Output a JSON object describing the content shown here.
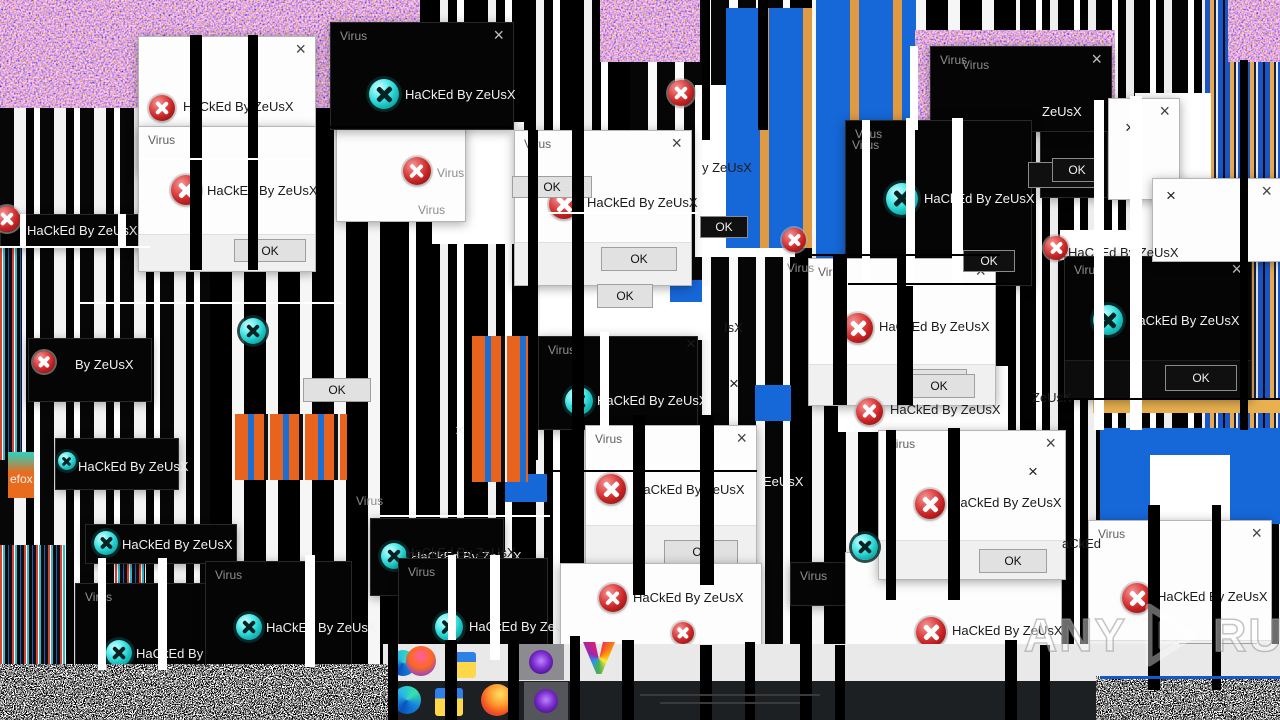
{
  "ui": {
    "virus_title": "Virus",
    "hacked_text": "HaCkEd By ZeUsX",
    "ok_label": "OK",
    "close_glyph": "×"
  },
  "watermark": {
    "left": "ANY",
    "right": "RUN"
  },
  "colors": {
    "dialog_light_bg": "#fdfdfd",
    "dialog_dark_bg": "#050505",
    "error_icon_red": "#c42222",
    "error_icon_cyan": "#1cc6c6",
    "glitch_blue": "#1667d8",
    "glitch_orange": "#e8641e",
    "taskbar_dark": "#1d2023"
  },
  "dialogs": [
    {
      "x": 0,
      "y": 214,
      "w": 148,
      "h": 32,
      "v": "dark",
      "bare": true,
      "close": false,
      "icon": "none",
      "msg": true,
      "mx": 26,
      "my": 8
    },
    {
      "x": 55,
      "y": 438,
      "w": 122,
      "h": 50,
      "v": "dark",
      "bare": true,
      "close": false,
      "icon": "none",
      "msg": true,
      "mx": 22,
      "my": 20
    },
    {
      "x": 28,
      "y": 338,
      "w": 122,
      "h": 62,
      "v": "dark",
      "bare": true,
      "close": false,
      "icon": "red",
      "ix": 4,
      "iy": 12,
      "is": 22,
      "msg": false
    },
    {
      "x": 790,
      "y": 562,
      "w": 70,
      "h": 42,
      "v": "dark",
      "title": "Virus",
      "close": false,
      "icon": "none",
      "msg": false
    },
    {
      "x": 1040,
      "y": 92,
      "w": 66,
      "h": 104,
      "v": "dark",
      "bare": true,
      "close": false,
      "icon": "none",
      "msg": false
    },
    {
      "x": 336,
      "y": 124,
      "w": 128,
      "h": 96,
      "v": "light",
      "bare": true,
      "close": false,
      "icon": "red",
      "ix": 66,
      "iy": 32,
      "is": 28,
      "msg": false
    },
    {
      "x": 138,
      "y": 36,
      "w": 176,
      "h": 136,
      "v": "light",
      "title": "",
      "close": true,
      "icon": "red",
      "ix": 10,
      "iy": 58,
      "is": 26,
      "msg": true,
      "mx": 44,
      "my": 62
    },
    {
      "x": 138,
      "y": 126,
      "w": 176,
      "h": 144,
      "v": "light",
      "title": "Virus",
      "close": false,
      "icon": "red",
      "ix": 32,
      "iy": 48,
      "is": 30,
      "msg": true,
      "mx": 68,
      "my": 56,
      "fh": 36,
      "ok": {
        "x": 95,
        "y": 112,
        "w": 72,
        "h": 23
      }
    },
    {
      "x": 330,
      "y": 22,
      "w": 182,
      "h": 106,
      "v": "dark",
      "title": "Virus",
      "close": true,
      "icon": "cyan",
      "ix": 38,
      "iy": 56,
      "is": 30,
      "msg": true,
      "mx": 74,
      "my": 64
    },
    {
      "x": 930,
      "y": 46,
      "w": 180,
      "h": 84,
      "v": "dark",
      "title": "Virus",
      "close": true,
      "icon": "none",
      "msg": false
    },
    {
      "x": 845,
      "y": 120,
      "w": 185,
      "h": 164,
      "v": "dark",
      "title": "Virus",
      "close": false,
      "icon": "cyan",
      "ix": 40,
      "iy": 62,
      "is": 32,
      "msg": true,
      "mx": 78,
      "my": 70
    },
    {
      "x": 514,
      "y": 130,
      "w": 176,
      "h": 154,
      "v": "light",
      "title": "Virus",
      "close": true,
      "icon": "red",
      "ix": 34,
      "iy": 58,
      "is": 30,
      "msg": true,
      "mx": 72,
      "my": 64,
      "fh": 42,
      "ok": {
        "x": 86,
        "y": 116,
        "w": 76,
        "h": 24
      }
    },
    {
      "x": 808,
      "y": 258,
      "w": 186,
      "h": 146,
      "v": "light",
      "title": "Virus",
      "close": true,
      "icon": "red",
      "ix": 34,
      "iy": 54,
      "is": 30,
      "msg": true,
      "mx": 70,
      "my": 60,
      "fh": 40,
      "ok": {
        "x": 90,
        "y": 110,
        "w": 68,
        "h": 24
      }
    },
    {
      "x": 1064,
      "y": 256,
      "w": 186,
      "h": 142,
      "v": "dark",
      "title": "Virus",
      "close": true,
      "icon": "cyan",
      "ix": 28,
      "iy": 48,
      "is": 30,
      "msg": true,
      "mx": 64,
      "my": 56,
      "fh": 38,
      "ok": {
        "x": 100,
        "y": 108,
        "w": 72,
        "h": 26
      }
    },
    {
      "x": 538,
      "y": 336,
      "w": 158,
      "h": 92,
      "v": "dark",
      "title": "Virus",
      "close": false,
      "icon": "cyan",
      "ix": 26,
      "iy": 50,
      "is": 28,
      "msg": true,
      "mx": 58,
      "my": 56
    },
    {
      "x": 1108,
      "y": 98,
      "w": 70,
      "h": 100,
      "v": "light",
      "title": "",
      "close": true,
      "icon": "none",
      "msg": false
    },
    {
      "x": 1152,
      "y": 178,
      "w": 128,
      "h": 82,
      "v": "light",
      "title": "",
      "close": true,
      "icon": "none",
      "msg": false
    },
    {
      "x": 585,
      "y": 425,
      "w": 170,
      "h": 144,
      "v": "light",
      "title": "Virus",
      "close": true,
      "icon": "red",
      "ix": 10,
      "iy": 48,
      "is": 30,
      "msg": true,
      "mx": 48,
      "my": 56,
      "fh": 44,
      "ok": {
        "x": 78,
        "y": 114,
        "w": 74,
        "h": 24
      }
    },
    {
      "x": 370,
      "y": 518,
      "w": 132,
      "h": 76,
      "v": "dark",
      "bare": true,
      "close": false,
      "icon": "cyan",
      "ix": 10,
      "iy": 24,
      "is": 26,
      "msg": true,
      "mx": 40,
      "my": 30
    },
    {
      "x": 398,
      "y": 558,
      "w": 148,
      "h": 102,
      "v": "dark",
      "title": "Virus",
      "close": false,
      "icon": "cyan",
      "ix": 36,
      "iy": 54,
      "is": 28,
      "msg": true,
      "mx": 70,
      "my": 60
    },
    {
      "x": 85,
      "y": 524,
      "w": 150,
      "h": 38,
      "v": "dark",
      "bare": true,
      "close": false,
      "icon": "cyan",
      "ix": 8,
      "iy": 6,
      "is": 24,
      "msg": true,
      "mx": 36,
      "my": 12
    },
    {
      "x": 75,
      "y": 583,
      "w": 132,
      "h": 84,
      "v": "dark",
      "title": "Virus",
      "close": false,
      "icon": "cyan",
      "ix": 30,
      "iy": 56,
      "is": 26,
      "msg": true,
      "mx": 60,
      "my": 62
    },
    {
      "x": 205,
      "y": 561,
      "w": 145,
      "h": 106,
      "v": "dark",
      "title": "Virus",
      "close": false,
      "icon": "cyan",
      "ix": 30,
      "iy": 52,
      "is": 26,
      "msg": true,
      "mx": 60,
      "my": 58
    },
    {
      "x": 560,
      "y": 563,
      "w": 200,
      "h": 98,
      "v": "light",
      "bare": true,
      "close": false,
      "icon": "red",
      "ix": 38,
      "iy": 20,
      "is": 28,
      "msg": true,
      "mx": 72,
      "my": 26
    },
    {
      "x": 845,
      "y": 552,
      "w": 215,
      "h": 128,
      "v": "light",
      "bare": true,
      "close": false,
      "icon": "red",
      "ix": 70,
      "iy": 64,
      "is": 30,
      "msg": true,
      "mx": 106,
      "my": 70
    },
    {
      "x": 878,
      "y": 430,
      "w": 186,
      "h": 148,
      "v": "light",
      "title": "Virus",
      "close": true,
      "icon": "red",
      "ix": 36,
      "iy": 58,
      "is": 30,
      "msg": true,
      "mx": 72,
      "my": 64,
      "fh": 38,
      "ok": {
        "x": 100,
        "y": 118,
        "w": 68,
        "h": 24
      }
    },
    {
      "x": 1088,
      "y": 520,
      "w": 182,
      "h": 160,
      "v": "light",
      "title": "Virus",
      "close": true,
      "icon": "red",
      "ix": 33,
      "iy": 62,
      "is": 30,
      "msg": true,
      "mx": 68,
      "my": 68,
      "fh": 40,
      "ok": {
        "x": 90,
        "y": 122,
        "w": 78,
        "h": 26
      }
    }
  ],
  "buttons": [
    {
      "x": 512,
      "y": 176,
      "w": 80,
      "h": 22,
      "v": "light"
    },
    {
      "x": 597,
      "y": 284,
      "w": 56,
      "h": 24,
      "v": "light"
    },
    {
      "x": 303,
      "y": 378,
      "w": 68,
      "h": 24,
      "v": "light"
    },
    {
      "x": 903,
      "y": 374,
      "w": 72,
      "h": 24,
      "v": "light"
    },
    {
      "x": 700,
      "y": 216,
      "w": 48,
      "h": 22,
      "v": "dark"
    },
    {
      "x": 963,
      "y": 250,
      "w": 52,
      "h": 22,
      "v": "dark"
    },
    {
      "x": 1028,
      "y": 162,
      "w": 74,
      "h": 26,
      "v": "dark"
    },
    {
      "x": 1052,
      "y": 158,
      "w": 50,
      "h": 24,
      "v": "dark"
    },
    {
      "x": 1188,
      "y": 684,
      "w": 60,
      "h": 24,
      "v": "dark"
    },
    {
      "x": 988,
      "y": 685,
      "w": 46,
      "h": 22,
      "v": "dark"
    }
  ],
  "icons": [
    {
      "x": 668,
      "y": 80,
      "s": 26,
      "variant": "red"
    },
    {
      "x": 856,
      "y": 398,
      "s": 27,
      "variant": "red"
    },
    {
      "x": 852,
      "y": 534,
      "s": 26,
      "variant": "cyan"
    },
    {
      "x": 240,
      "y": 318,
      "s": 26,
      "variant": "cyan"
    },
    {
      "x": -6,
      "y": 206,
      "s": 26,
      "variant": "red"
    },
    {
      "x": 58,
      "y": 452,
      "s": 18,
      "variant": "cyan"
    },
    {
      "x": 672,
      "y": 622,
      "s": 22,
      "variant": "red"
    },
    {
      "x": 1044,
      "y": 236,
      "s": 24,
      "variant": "red"
    },
    {
      "x": 782,
      "y": 228,
      "s": 24,
      "variant": "red"
    }
  ],
  "fragments": [
    {
      "x": 75,
      "y": 357,
      "text": "By ZeUsX",
      "tone": "light"
    },
    {
      "x": 1042,
      "y": 104,
      "text": "ZeUsX",
      "tone": "light"
    },
    {
      "x": 1032,
      "y": 390,
      "text": "ZeUsX",
      "tone": "dark"
    },
    {
      "x": 1068,
      "y": 245,
      "text": "HaCkEd By ZeUsX",
      "tone": "dark"
    },
    {
      "x": 890,
      "y": 402,
      "text": "HaCkEd By ZeUsX",
      "tone": "dark"
    },
    {
      "x": 405,
      "y": 545,
      "text": "HaCkEd By ZeUsX",
      "tone": "dark"
    },
    {
      "x": 1062,
      "y": 536,
      "text": "aCkEd",
      "tone": "dark"
    },
    {
      "x": 763,
      "y": 474,
      "text": "EeUsX",
      "tone": "light"
    },
    {
      "x": 724,
      "y": 320,
      "text": "IsX",
      "tone": "dark"
    },
    {
      "x": 702,
      "y": 160,
      "text": "y ZeUsX",
      "tone": "dark"
    },
    {
      "x": 746,
      "y": 643,
      "text": "HaCkEd By",
      "tone": "faint",
      "s": 12
    },
    {
      "x": 437,
      "y": 166,
      "text": "Virus",
      "tone": "gray",
      "s": 12
    },
    {
      "x": 418,
      "y": 203,
      "text": "Virus",
      "tone": "gray",
      "s": 12
    },
    {
      "x": 962,
      "y": 58,
      "text": "Virus",
      "tone": "gray",
      "s": 12
    },
    {
      "x": 787,
      "y": 261,
      "text": "Virus",
      "tone": "gray",
      "s": 12
    },
    {
      "x": 852,
      "y": 138,
      "text": "Virus",
      "tone": "gray",
      "s": 12
    },
    {
      "x": 356,
      "y": 494,
      "text": "Virus",
      "tone": "gray",
      "s": 12
    },
    {
      "x": 10,
      "y": 472,
      "text": "efox",
      "tone": "light",
      "s": 12
    },
    {
      "x": 1125,
      "y": 118,
      "text": "×",
      "tone": "dark",
      "s": 17
    },
    {
      "x": 1166,
      "y": 186,
      "text": "×",
      "tone": "dark",
      "s": 17
    },
    {
      "x": 686,
      "y": 334,
      "text": "×",
      "tone": "dark",
      "s": 17
    },
    {
      "x": 729,
      "y": 374,
      "text": "×",
      "tone": "dark",
      "s": 17
    },
    {
      "x": 1028,
      "y": 462,
      "text": "×",
      "tone": "dark",
      "s": 17
    },
    {
      "x": 455,
      "y": 421,
      "text": "×",
      "tone": "light",
      "s": 17
    }
  ],
  "taskbar": {
    "items": [
      {
        "type": "edge",
        "x": 390,
        "y": 650,
        "s": 26,
        "row": 1
      },
      {
        "type": "firefox-glitch",
        "x": 406,
        "y": 646,
        "s": 30,
        "row": 1
      },
      {
        "type": "folder",
        "x": 450,
        "y": 652,
        "s": 26,
        "row": 1
      },
      {
        "type": "purple-tile",
        "x": 518,
        "y": 644,
        "w": 46,
        "h": 36,
        "row": 1
      },
      {
        "type": "glitch-v",
        "x": 583,
        "y": 642,
        "s": 32,
        "row": 1
      },
      {
        "type": "edge",
        "x": 393,
        "y": 686,
        "s": 28,
        "row": 2
      },
      {
        "type": "folder",
        "x": 435,
        "y": 688,
        "s": 28,
        "row": 2
      },
      {
        "type": "firefox",
        "x": 481,
        "y": 684,
        "s": 32,
        "row": 2
      },
      {
        "type": "purple-tile",
        "x": 524,
        "y": 682,
        "w": 44,
        "h": 38,
        "row": 2
      }
    ]
  }
}
